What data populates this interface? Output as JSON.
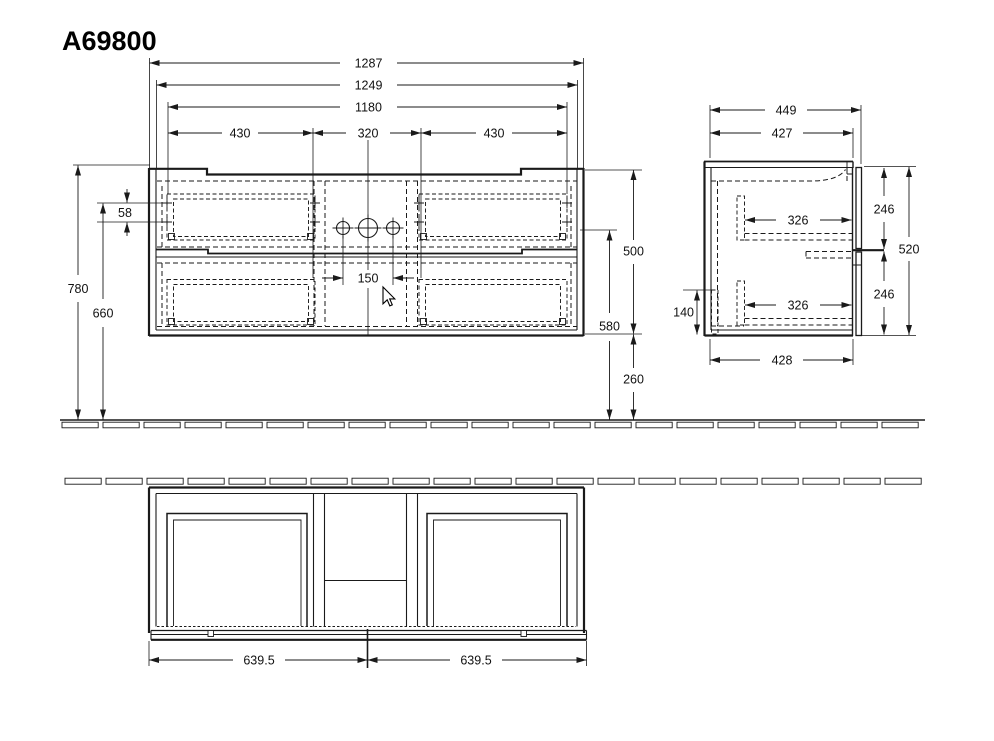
{
  "title": "A69800",
  "colors": {
    "line": "#1a1a1a",
    "background": "#ffffff"
  },
  "dims": {
    "front": {
      "total_width": "1287",
      "inner_width": "1249",
      "carcass_width": "1180",
      "drawer_left": "430",
      "center_section": "320",
      "drawer_right": "430",
      "faucet_holes": "150",
      "mount_hole_offset": "58",
      "height_top": "780",
      "height_mount": "660",
      "carcass_height": "500",
      "drain_height": "580",
      "floor_clearance": "260"
    },
    "side": {
      "depth_total": "449",
      "depth_top": "427",
      "drawer_inner_top": "326",
      "drawer_inner_bottom": "326",
      "front_upper": "246",
      "front_lower": "246",
      "carcass_height": "520",
      "service_gap": "140",
      "depth_bottom": "428"
    },
    "plan": {
      "half_left": "639.5",
      "half_right": "639.5"
    }
  }
}
